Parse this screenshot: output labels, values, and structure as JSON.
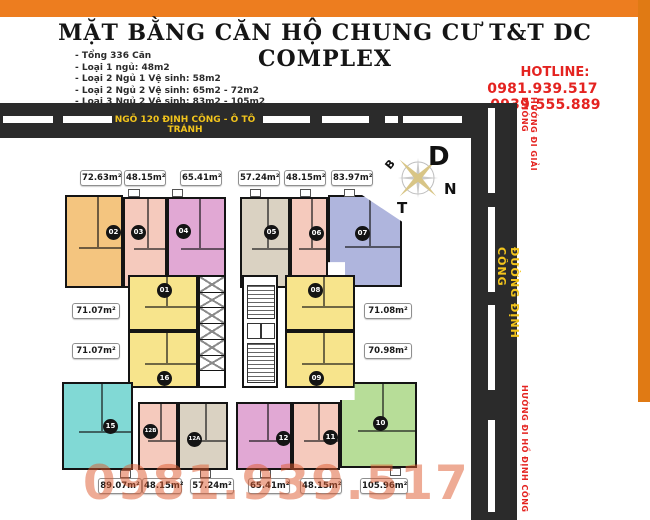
{
  "header": {
    "title": "MẶT BẰNG CĂN HỘ CHUNG CƯ T&T DC COMPLEX",
    "info_lines": [
      "- Tổng 336 Căn",
      "- Loại 1 ngủ: 48m2",
      "- Loại 2 Ngủ 1 Vệ sinh: 58m2",
      "- Loại 2 Ngủ 2 Vệ sinh: 65m2 - 72m2",
      "- Loại 3 Ngủ 2 Vệ sinh: 83m2 - 105m2"
    ],
    "hotline_label": "HOTLINE:",
    "hotline_numbers": "0981.939.517 -0939.555.889"
  },
  "roads": {
    "top_label": "NGÕ 120 ĐỊNH CÔNG - Ô TÔ TRÁNH",
    "right_label": "ĐƯỜNG ĐỊNH CÔNG",
    "direction_top": "HƯỚNG ĐI GIẢI PHÓNG",
    "direction_bottom": "HƯỚNG ĐI HỒ ĐỊNH CÔNG"
  },
  "compass": {
    "east": "D",
    "north": "B",
    "south": "N",
    "west": "T"
  },
  "watermark": "0981.939.517",
  "colors": {
    "frame_orange": "#ED7D1F",
    "road": "#2B2B2B",
    "road_text": "#F2C41C",
    "hotline_red": "#E42320"
  },
  "units": [
    {
      "number": "01",
      "area": "71.07m²",
      "color": "#F7E48C"
    },
    {
      "number": "02",
      "area": "72.63m²",
      "color": "#F4C57F"
    },
    {
      "number": "03",
      "area": "48.15m²",
      "color": "#F5CABD"
    },
    {
      "number": "04",
      "area": "65.41m²",
      "color": "#E1A8D4"
    },
    {
      "number": "05",
      "area": "57.24m²",
      "color": "#DAD2C2"
    },
    {
      "number": "06",
      "area": "48.15m²",
      "color": "#F5CABD"
    },
    {
      "number": "07",
      "area": "83.97m²",
      "color": "#AFB5DD"
    },
    {
      "number": "08",
      "area": "71.08m²",
      "color": "#F7E48C"
    },
    {
      "number": "09",
      "area": "70.98m²",
      "color": "#F7E48C"
    },
    {
      "number": "10",
      "area": "105.96m²",
      "color": "#B7DD98"
    },
    {
      "number": "11",
      "area": "48.15m²",
      "color": "#F5CABD"
    },
    {
      "number": "12",
      "area": "65.41m²",
      "color": "#E1A8D4"
    },
    {
      "number": "12A",
      "area": "57.24m²",
      "color": "#DAD2C2"
    },
    {
      "number": "12B",
      "area": "48.15m²",
      "color": "#F5CABD"
    },
    {
      "number": "15",
      "area": "89.07m²",
      "color": "#81D9D5"
    },
    {
      "number": "16",
      "area": "71.07m²",
      "color": "#F7E48C"
    }
  ]
}
